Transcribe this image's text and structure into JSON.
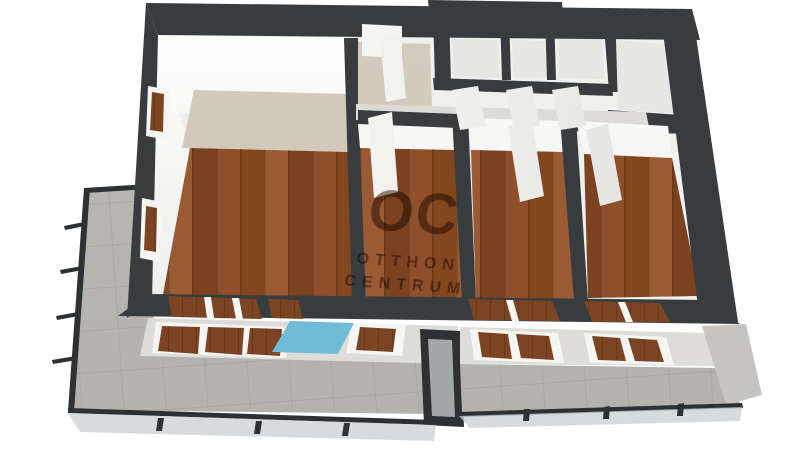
{
  "watermark": {
    "logo": "OC",
    "line1": "OTTHON",
    "line2": "CENTRUM"
  },
  "colors": {
    "wall-dark": "#393c3f",
    "rail-dark": "#2e3134",
    "wood-a": "#7c4220",
    "wood-b": "#8f4f2a",
    "wood-c": "#84461f",
    "wood-d": "#9a5a33",
    "wood-window": "#7b4524",
    "floor-beige": "#cbc3b3",
    "tile-gray": "#b3b1ac",
    "hall-floor": "#dcdbd7",
    "utility-floor": "#e7e7e5",
    "facade-light": "#d6d5d2",
    "panel-blue": "#67b4d2",
    "glass-light": "#c9cfd2",
    "watermark-brown": "rgba(70,40,18,0.55)"
  }
}
